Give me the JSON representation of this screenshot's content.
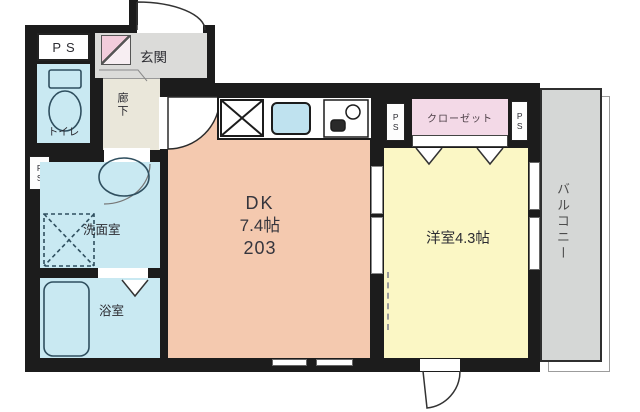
{
  "floorplan": {
    "rooms": {
      "dk": {
        "name_label": "DK",
        "size_label": "7.4帖",
        "unit_label": "203"
      },
      "western": {
        "label": "洋室4.3帖"
      },
      "entrance": {
        "label": "玄関"
      },
      "toilet": {
        "label": "トイレ"
      },
      "hallway": {
        "label": "廊下"
      },
      "washroom": {
        "label": "洗面室"
      },
      "bathroom": {
        "label": "浴室"
      },
      "closet": {
        "label": "クローゼット"
      },
      "balcony": {
        "label": "バルコニー"
      }
    },
    "ps_labels": {
      "top_left": "PS",
      "wall_left": "PS",
      "closet_left": "PS",
      "closet_right": "PS"
    }
  },
  "colors": {
    "wall": "#1c1c1c",
    "dk_fill": "#f4c9af",
    "western_fill": "#fbf7c5",
    "wet_fill": "#c9e9f2",
    "entrance_fill": "#dbdbd9",
    "hallway_fill": "#eae7da",
    "closet_fill": "#f3d9e7",
    "shoebox_fill": "#f2ccdb",
    "balcony_fill": "#d5d7d6",
    "kitchen_sink_fill": "#bfe2ef"
  }
}
